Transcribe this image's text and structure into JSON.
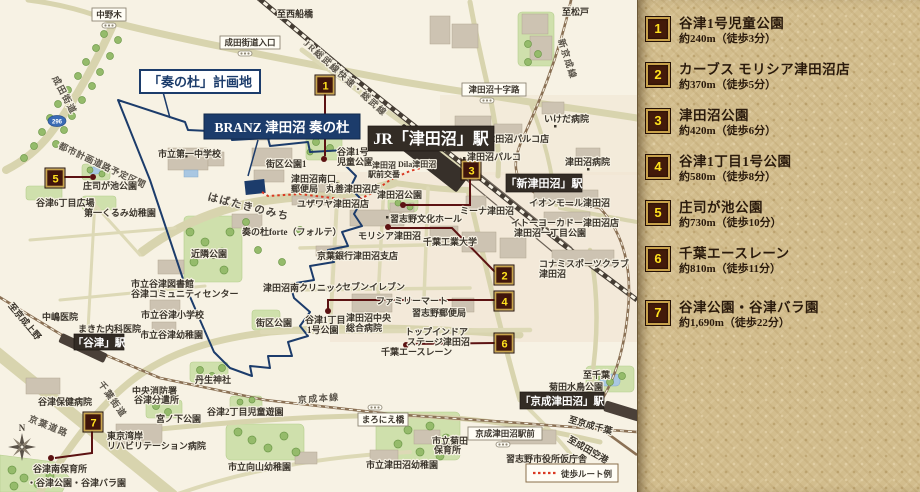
{
  "legend": {
    "items": [
      {
        "num": "1",
        "name": "谷津1号児童公園",
        "distance": "約240m（徒歩3分）"
      },
      {
        "num": "2",
        "name": "カーブス モリシア津田沼店",
        "distance": "約370m（徒歩5分）"
      },
      {
        "num": "3",
        "name": "津田沼公園",
        "distance": "約420m（徒歩6分）"
      },
      {
        "num": "4",
        "name": "谷津1丁目1号公園",
        "distance": "約580m（徒歩8分）"
      },
      {
        "num": "5",
        "name": "庄司が池公園",
        "distance": "約730m（徒歩10分）"
      },
      {
        "num": "6",
        "name": "千葉エースレーン",
        "distance": "約810m（徒歩11分）"
      },
      {
        "num": "7",
        "name": "谷津公園・谷津バラ園",
        "distance": "約1,690m（徒歩22分）"
      }
    ]
  },
  "site": {
    "plan_label": "「奏の杜」計画地",
    "branz_label": "BRANZ 津田沼 奏の杜"
  },
  "stations": {
    "jr": "JR「津田沼」駅",
    "shin": "「新津田沼」駅",
    "yatsu": "「谷津」駅",
    "keisei": "「京成津田沼」駅"
  },
  "boxed": {
    "nakanogi": "中野木",
    "narita_iriguchi": "成田街道入口",
    "jujiro": "津田沼十字路",
    "maronie": "まろにえ橋",
    "keisei_ekimae": "京成津田沼駅前"
  },
  "directions": {
    "nishifunabashi": "至西船橋",
    "matsudo": "至松戸",
    "keisei_ueno": "至京成上野",
    "chiba": "至千葉",
    "keisei_chiba": "至京成千葉",
    "narita_airport": "至成田空港"
  },
  "roads": {
    "jr_sobu": "JR総武線快速・総武線",
    "shinkeisei": "新京成線",
    "keisei_honsen": "京成本線",
    "narita_kaido": "成田街道",
    "chiba_kaido": "千葉街道",
    "keiyo_doro": "京葉道路",
    "toshi_keikaku": "都市計画道路予定区間",
    "habataki": "はばたきのみち"
  },
  "labels": {
    "daiichi_chu": "市立第一中学校",
    "gaiku1": "街区公園1",
    "yatsu1go_a": "谷津1号",
    "yatsu1go_b": "児童公園",
    "minamiguchi_a": "津田沼南口",
    "minamiguchi_b": "郵便局",
    "maruzen": "丸善津田沼店",
    "yuzawaya": "ユザワヤ津田沼店",
    "koban_a": "津田沼",
    "koban_b": "駅前交番",
    "dila": "Dila津田沼",
    "seiyu": "西友 津田沼パルコ店",
    "parco": "津田沼パルコ",
    "ikeda": "いけだ病院",
    "tsudanuma_byoin": "津田沼病院",
    "aeon": "イオンモール津田沼",
    "itoyokado": "イトーヨーカドー津田沼店",
    "tsudanuma1_koen": "津田沼一丁目公園",
    "konami_a": "コナミスポーツクラブ",
    "konami_b": "津田沼",
    "mina": "ミーナ津田沼",
    "bunka": "習志野文化ホール",
    "morisia": "モリシア津田沼",
    "kodai": "千葉工業大学",
    "keiyo_bank": "京葉銀行津田沼支店",
    "forte": "奏の杜forte（フォルテ）",
    "kinrin": "近隣公園",
    "tsudanuma_koen": "津田沼公園",
    "minami_clinic": "津田沼南クリニック",
    "seven": "セブンイレブン",
    "famima": "ファミリーマート",
    "nara_yubin": "習志野郵便局",
    "chuo_a": "津田沼中央",
    "chuo_b": "総合病院",
    "topindoor_a": "トップインドア",
    "topindoor_b": "ステージ津田沼",
    "acelane": "千葉エースレーン",
    "tosho_a": "市立谷津図書館",
    "tosho_b": "谷津コミュニティセンター",
    "yatsu_sho": "市立谷津小学校",
    "yatsu_yochien": "市立谷津幼稚園",
    "nakajima": "中嶋医院",
    "makita": "まきた内科医院",
    "yatsu6": "谷津6丁目広場",
    "kurumi": "第一くるみ幼稚園",
    "shoji": "庄司が池公園",
    "yatsu_hoken": "谷津保健病院",
    "shobo_a": "中央消防署",
    "shobo_b": "谷津分遣所",
    "miyanoshita": "宮ノ下公園",
    "nyu": "丹生神社",
    "yatsu2": "谷津2丁目児童遊園",
    "wangan_a": "東京湾岸",
    "wangan_b": "リハビリテーション病院",
    "mukaiyama": "市立向山幼稚園",
    "kikuta_a": "市立菊田",
    "kikuta_b": "保育所",
    "tsudanuma_yochien": "市立津田沼幼稚園",
    "shiyakusho": "習志野市役所仮庁舎",
    "mizudori": "菊田水鳥公園",
    "gaiku_s": "街区公園",
    "yatsu1chome_a": "谷津1丁目",
    "yatsu1chome_b": "1号公園",
    "minami_hoiku": "谷津南保育所",
    "yatsu_koen": "・谷津公園・谷津バラ園"
  },
  "route_legend": "徒歩ルート例",
  "compass": "N",
  "shield": "296",
  "colors": {
    "site_navy": "#1c3c6b",
    "marker_red": "#40150b",
    "marker_gold": "#c9a44c",
    "marker_num_yellow": "#ffe11e",
    "route_red": "#da3821",
    "panel_tan": "#d2bd8d",
    "map_cream": "#f7f2e4"
  }
}
